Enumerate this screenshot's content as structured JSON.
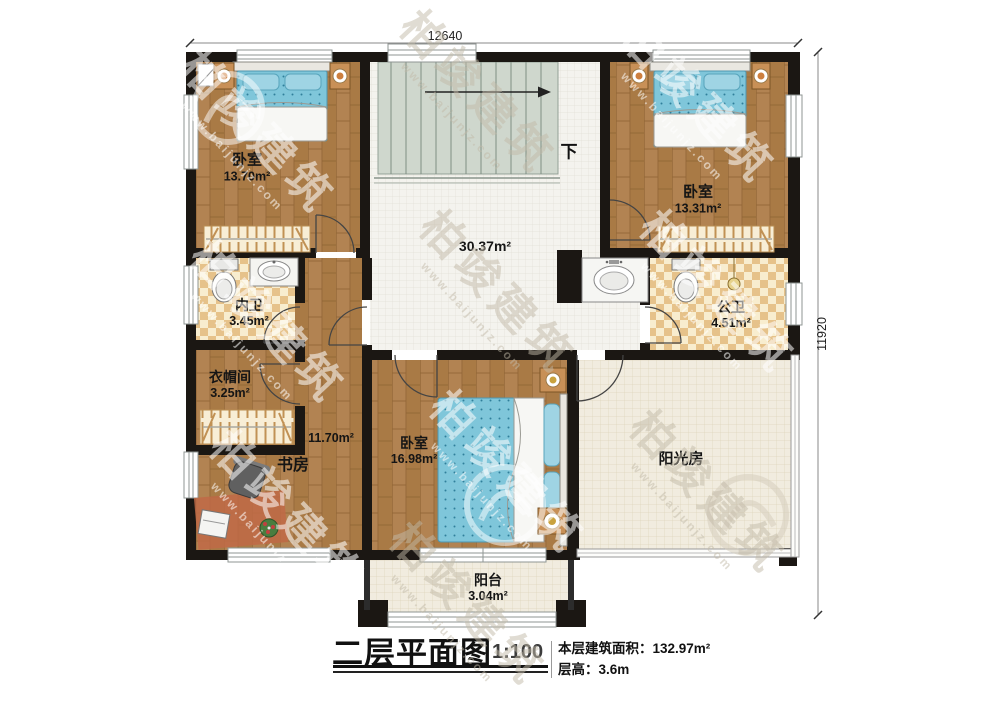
{
  "dimensions": {
    "top": "12640",
    "right": "11920"
  },
  "stairs": {
    "down_label": "下"
  },
  "rooms": {
    "bedroom_top_left": {
      "name": "卧室",
      "area": "13.70m²"
    },
    "bedroom_top_right": {
      "name": "卧室",
      "area": "13.31m²"
    },
    "hall": {
      "area": "30.37m²"
    },
    "bath_inner": {
      "name": "内卫",
      "area": "3.45m²"
    },
    "bath_public": {
      "name": "公卫",
      "area": "4.51m²"
    },
    "cloakroom": {
      "name": "衣帽间",
      "area": "3.25m²"
    },
    "study": {
      "name": "书房",
      "area": "11.70m²"
    },
    "bedroom_bottom": {
      "name": "卧室",
      "area": "16.98m²"
    },
    "sunroom": {
      "name": "阳光房"
    },
    "balcony": {
      "name": "阳台",
      "area": "3.04m²"
    }
  },
  "title_block": {
    "title": "二层平面图",
    "scale": "1:100",
    "floor_area": "本层建筑面积：132.97m²",
    "floor_height": "层高：3.6m"
  },
  "watermark": {
    "brand": "柏竣建筑",
    "url": "www.baijunjz.com"
  },
  "colors": {
    "wall": "#1b1713",
    "wood_floor": "#b28352",
    "white_tile": "#f4f3ee",
    "checker_tile": "#e6c28a",
    "beige_tile": "#f1ecdf",
    "mattress_blue": "#7fc6da",
    "stair_fill": "#cfd7cd",
    "lamp_orange": "#cd7f3f"
  }
}
